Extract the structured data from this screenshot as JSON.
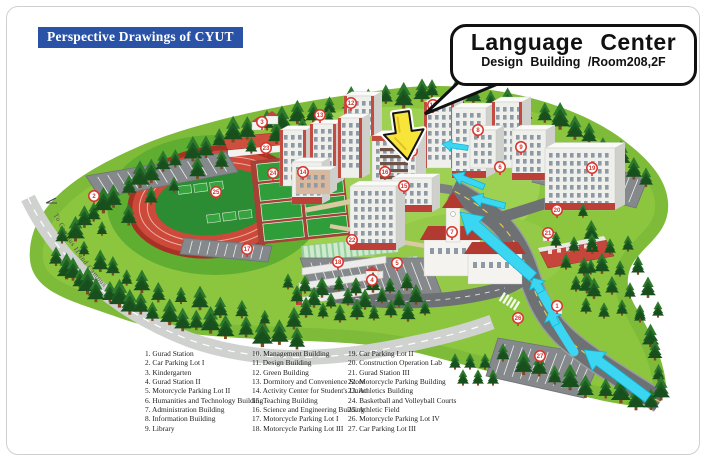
{
  "title": "Perspective Drawings of CYUT",
  "callout": {
    "title": "Language Center",
    "subtitle": "Design Building /Room208,2F"
  },
  "map": {
    "road_label": "To Campus II and Campus III"
  },
  "colors": {
    "accent_blue": "#2a53a7",
    "campus_green": "#8cc63f",
    "arrow_cyan": "#3bd7f2",
    "marker_red": "#d7342c",
    "highlight_yellow": "#f8e53a"
  },
  "legend": {
    "items": [
      "1. Gurad Station",
      "2. Car Parking Lot I",
      "3. Kindergarten",
      "4. Gurad Station II",
      "5. Motorcycle Parking Lot II",
      "6. Humanities and Technology Building",
      "7. Administration Building",
      "8. Information Building",
      "9. Library",
      "10. Management Building",
      "11. Design Building",
      "12. Green Building",
      "13. Dormitory and Convenience Store",
      "14. Activity Center for Student's Union",
      "15. Teaching Building",
      "16. Science and Engineering Building",
      "17. Motorcycle Parking Lot I",
      "18. Motorcycle Parking Lot III",
      "19. Car Parking Lot II",
      "20. Construction Operation Lab",
      "21. Gurad Station III",
      "22. Motorcycle Parking Building",
      "23. Athletics Building",
      "24. Basketball and Volleyball Courts",
      "25. Athletic Field",
      "26. Motorcycle Parking Lot IV",
      "27. Car Parking Lot III"
    ]
  },
  "markers": [
    {
      "n": 1,
      "x": 557,
      "y": 306
    },
    {
      "n": 2,
      "x": 94,
      "y": 196
    },
    {
      "n": 3,
      "x": 262,
      "y": 122
    },
    {
      "n": 4,
      "x": 372,
      "y": 280
    },
    {
      "n": 5,
      "x": 397,
      "y": 263
    },
    {
      "n": 6,
      "x": 500,
      "y": 167
    },
    {
      "n": 7,
      "x": 452,
      "y": 232
    },
    {
      "n": 8,
      "x": 478,
      "y": 130
    },
    {
      "n": 9,
      "x": 521,
      "y": 147
    },
    {
      "n": 10,
      "x": 433,
      "y": 105
    },
    {
      "n": 11,
      "x": 412,
      "y": 151
    },
    {
      "n": 12,
      "x": 351,
      "y": 103
    },
    {
      "n": 13,
      "x": 320,
      "y": 115
    },
    {
      "n": 14,
      "x": 303,
      "y": 172
    },
    {
      "n": 15,
      "x": 404,
      "y": 186
    },
    {
      "n": 16,
      "x": 385,
      "y": 172
    },
    {
      "n": 17,
      "x": 247,
      "y": 249
    },
    {
      "n": 18,
      "x": 338,
      "y": 262
    },
    {
      "n": 19,
      "x": 592,
      "y": 168
    },
    {
      "n": 20,
      "x": 557,
      "y": 210
    },
    {
      "n": 21,
      "x": 548,
      "y": 233
    },
    {
      "n": 22,
      "x": 352,
      "y": 240
    },
    {
      "n": 23,
      "x": 266,
      "y": 148
    },
    {
      "n": 24,
      "x": 273,
      "y": 173
    },
    {
      "n": 25,
      "x": 216,
      "y": 192
    },
    {
      "n": 26,
      "x": 518,
      "y": 318
    },
    {
      "n": 27,
      "x": 540,
      "y": 356
    }
  ]
}
